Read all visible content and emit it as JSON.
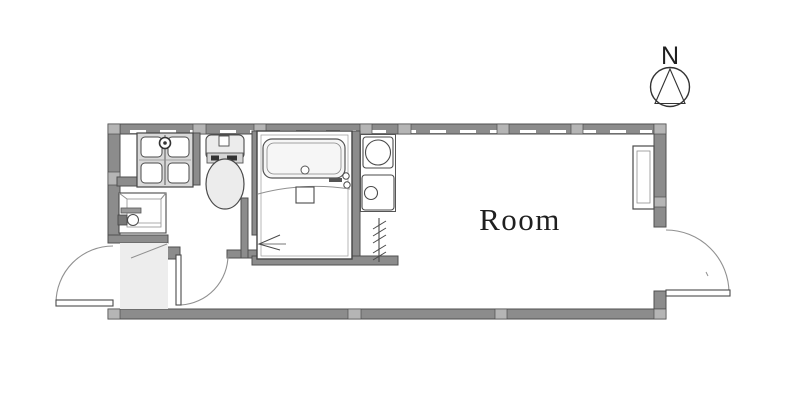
{
  "page": {
    "title": "Studio apartment floor plan"
  },
  "room": {
    "label": "Room"
  },
  "compass": {
    "label": "N"
  },
  "fixtures": {
    "washing_machine_pan": "washing-machine-pan",
    "toilet": "toilet",
    "washbasin": "washbasin",
    "unit_bath": "unit-bath",
    "bathtub": "bathtub",
    "bath_drain": "bath-drain",
    "kitchen_sink": "kitchen-sink",
    "stove": "stove-burner",
    "refrigerator_space": "hatched-line",
    "entrance": "genkan-entrance",
    "entrance_door": "entrance-door-swing",
    "washroom_door": "washroom-door-swing",
    "bathroom_door": "bath-folding-door-arrow",
    "side_door": "side-door-swing",
    "window_unit": "tall-window-unit",
    "north_indicator": "compass-circle-triangle"
  },
  "colors": {
    "background": "#ffffff",
    "wall": "#8c8c8c",
    "wall_edge": "#4f4f4f",
    "joint": "#b5b5b5",
    "line": "#4a4a4a",
    "line_soft": "#909090",
    "floor_light": "#ededed",
    "pan_fill": "#d9d9d9",
    "fixture_fill": "#ececec",
    "text": "#1f1f1f"
  }
}
